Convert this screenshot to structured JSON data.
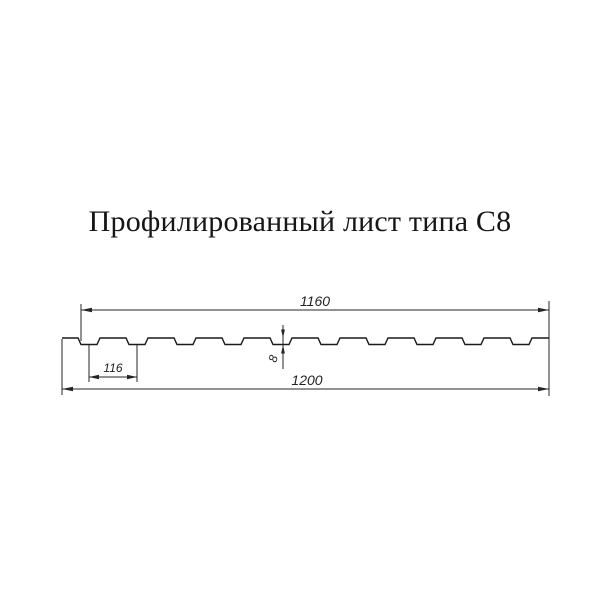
{
  "title": "Профилированный лист типа С8",
  "diagram": {
    "type": "profile-sheet-cross-section",
    "dimensions": {
      "working_width": "1160",
      "rib_pitch": "116",
      "profile_height": "8",
      "overall_width": "1200"
    },
    "profile": {
      "groove_count": 10
    },
    "colors": {
      "background": "#ffffff",
      "line": "#1f1f1f",
      "title_text": "#161616",
      "dim_text": "#222222"
    }
  }
}
